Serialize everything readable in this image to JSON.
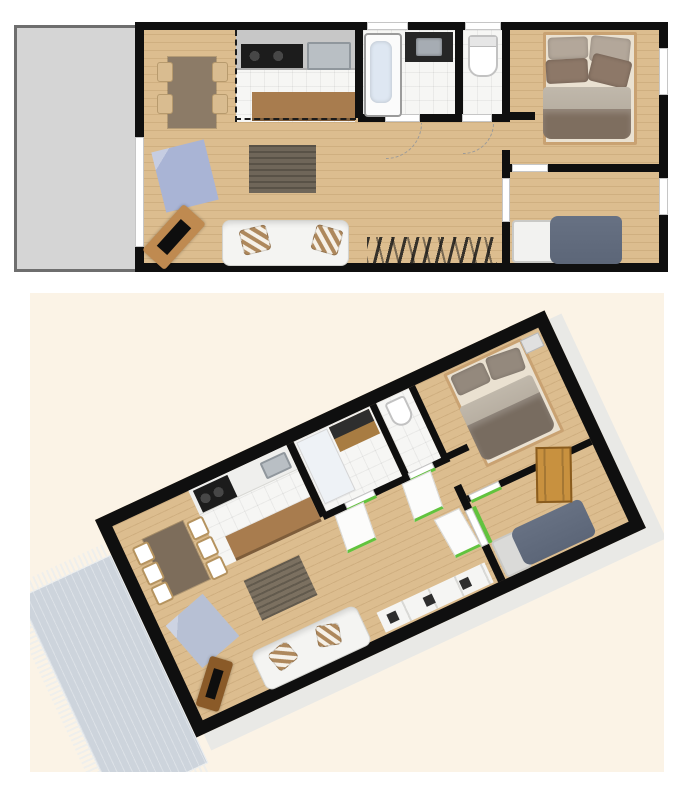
{
  "scene": {
    "views": [
      {
        "id": "plan-2d",
        "kind": "top-down-floor-plan"
      },
      {
        "id": "plan-3d",
        "kind": "rotated-perspective-floor-plan"
      }
    ],
    "rooms": [
      "terrace",
      "living-room",
      "dining-area",
      "kitchen",
      "bathroom",
      "wc",
      "hallway",
      "master-bedroom",
      "second-bedroom"
    ],
    "objects": [
      "dining-table",
      "dining-chair",
      "blue-rug",
      "dark-rug",
      "tv-sideboard",
      "tv",
      "sofa",
      "striped-pillow",
      "kitchen-counter",
      "cooktop",
      "kitchen-sink",
      "bar-counter",
      "bathtub",
      "vanity-sink",
      "toilet",
      "double-bed",
      "single-bed",
      "wardrobe-rack",
      "interior-door",
      "wall-vent",
      "window",
      "terrace-door",
      "door-swing-arc",
      "fringed-terrace-rug"
    ]
  },
  "colors": {
    "wall": "#0f0f0f",
    "wood": "#dcbd8f",
    "tile": "#f6f6f4",
    "terrace2d": "#d5d5d5",
    "terrace2d_border": "#6e6e6e",
    "cream": "#fbf3e6",
    "terrace3d": "#cdd4dc",
    "counter": "#c7c7c7",
    "appliance": "#1c1c1c",
    "sink": "#b9bfc4",
    "bar": "#a87c4e",
    "table": "#8c7b67",
    "chair": "#d9bc90",
    "rug_blue": "#a9b4d5",
    "rug_dark": "#6f6659",
    "sofa": "#f4f4f2",
    "pillow_stripe": "#ae885c",
    "sideboard": "#bf8a50",
    "bed_frame": "#c9a272",
    "pillow_light": "#b3a79a",
    "pillow_dark": "#8d7868",
    "mattress": "#eae1d1",
    "duvet": "#b6ada0",
    "blanket": "#7e6e5f",
    "bed2_blanket": "#5c6678",
    "tub": "#dee7f2",
    "green": "#62c33e",
    "door_wood": "#c8913f",
    "extrude": "#e9e9e6"
  }
}
